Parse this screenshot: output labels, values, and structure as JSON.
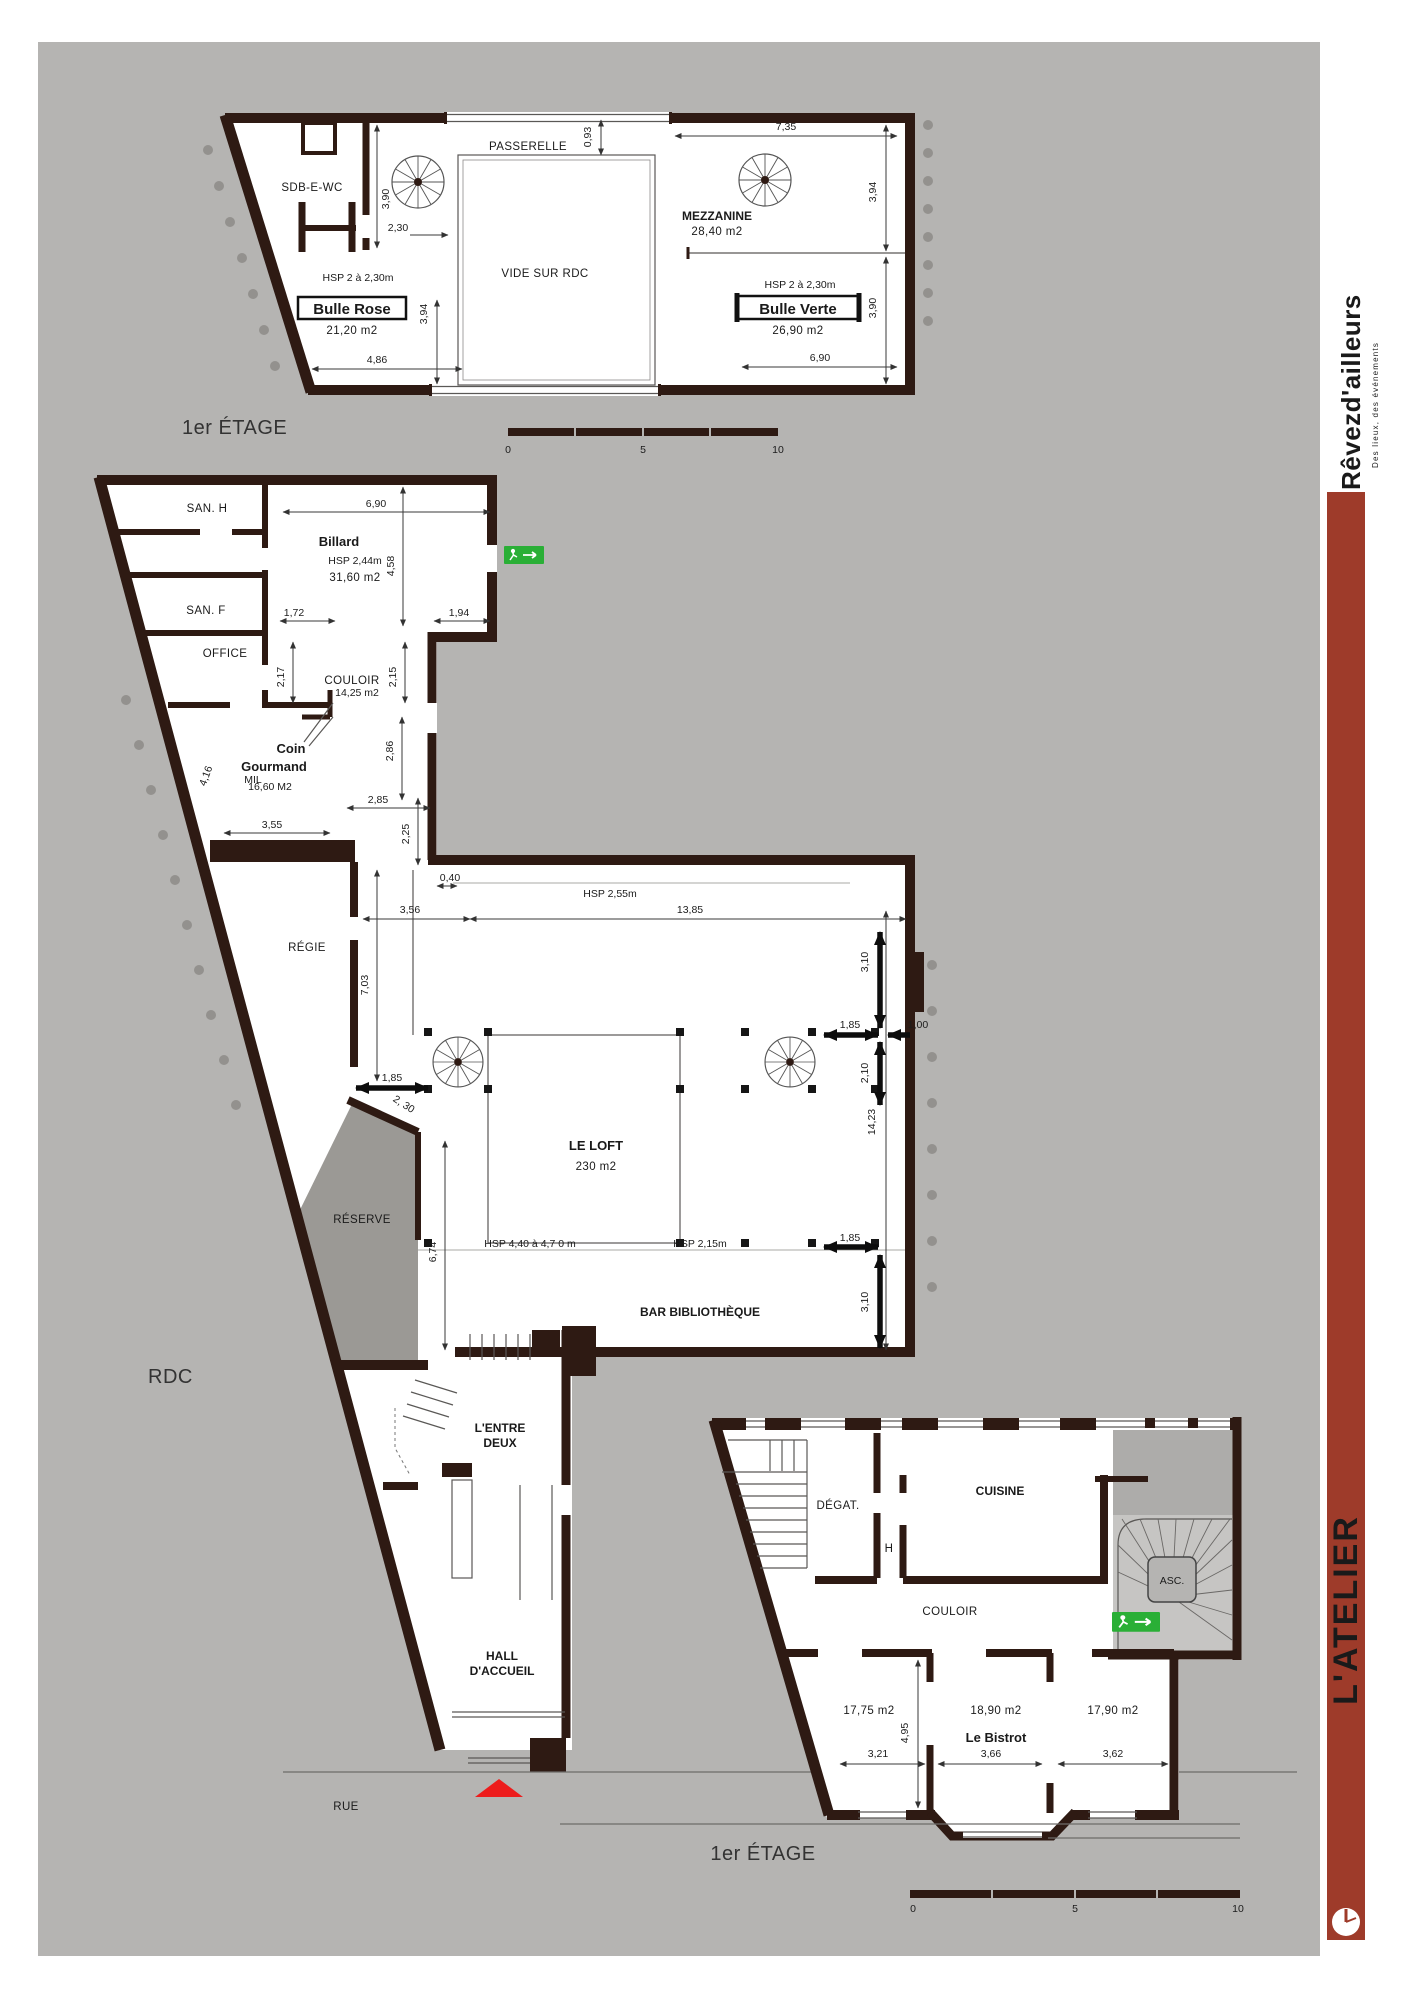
{
  "brand": {
    "logo": "Rêvezd'ailleurs",
    "tagline": "Des lieux, des événements",
    "name": "L'ATELIER"
  },
  "titles": {
    "top": "1er ÉTAGE",
    "rdc": "RDC",
    "bistrot": "1er ÉTAGE"
  },
  "street_label": "RUE",
  "scale": {
    "zero": "0",
    "five": "5",
    "ten": "10"
  },
  "colors": {
    "wall": "#2e1a13",
    "canvas": "#b5b4b2",
    "reserve_gray": "#9b9995",
    "accent_red": "#9e3b2a",
    "exit_green": "#2aaf36",
    "marker_red": "#ed1c1c"
  },
  "top_plan": {
    "labels": {
      "sdb": "SDB-E-WC",
      "passerelle": "PASSERELLE",
      "vide": "VIDE SUR RDC",
      "mezzanine": "MEZZANINE",
      "mezzanine_area": "28,40 m2",
      "hsp_left": "HSP 2 à 2,30m",
      "hsp_right": "HSP 2 à 2,30m",
      "bulle_rose": "Bulle Rose",
      "bulle_rose_area": "21,20 m2",
      "bulle_verte": "Bulle Verte",
      "bulle_verte_area": "26,90 m2"
    },
    "dims": {
      "d093": "0,93",
      "d735": "7,35",
      "d390_left": "3,90",
      "d230": "2,30",
      "d394_left": "3,94",
      "d486": "4,86",
      "d394_right": "3,94",
      "d390_right": "3,90",
      "d690": "6,90"
    }
  },
  "rdc_plan": {
    "labels": {
      "san_h": "SAN. H",
      "san_f": "SAN. F",
      "office": "OFFICE",
      "billard": "Billard",
      "billard_hsp": "HSP 2,44m",
      "billard_area": "31,60 m2",
      "couloir": "COULOIR",
      "couloir_area": "14,25 m2",
      "coin_line1": "Coin",
      "coin_line2": "Gourmand",
      "mil": "MIL",
      "mil_area": "16,60 M2",
      "regie": "RÉGIE",
      "reserve": "RÉSERVE",
      "hsp_loft": "HSP 2,55m",
      "loft": "LE LOFT",
      "loft_area": "230 m2",
      "hsp_high": "HSP 4,40 à 4,7 0 m",
      "hsp_215": "HSP 2,15m",
      "bar": "BAR BIBLIOTHÈQUE",
      "entre_line1": "L'ENTRE",
      "entre_line2": "DEUX",
      "hall_line1": "HALL",
      "hall_line2": "D'ACCUEIL"
    },
    "dims": {
      "d690": "6,90",
      "d458": "4,58",
      "d172": "1,72",
      "d194": "1,94",
      "d217": "2,17",
      "d215": "2,15",
      "d286": "2,86",
      "d285": "2,85",
      "d355": "3,55",
      "d225": "2,25",
      "d416": "4,16",
      "d040": "0,40",
      "d356": "3,56",
      "d1385": "13,85",
      "d310_top": "3,10",
      "d703": "7,03",
      "d185_left": "1,85",
      "d185_right": "1,85",
      "d100": "1,00",
      "d210": "2,10",
      "d230_diag": "2, 30",
      "d1423": "14,23",
      "d674": "6,74",
      "d185_bottom": "1,85",
      "d310_bottom": "3,10"
    }
  },
  "bistrot_plan": {
    "labels": {
      "degat": "DÉGAT.",
      "h": "H",
      "cuisine": "CUISINE",
      "couloir": "COULOIR",
      "asc": "ASC.",
      "area1": "17,75 m2",
      "area2": "18,90 m2",
      "area3": "17,90 m2",
      "bistrot": "Le Bistrot"
    },
    "dims": {
      "d495": "4,95",
      "d321": "3,21",
      "d366": "3,66",
      "d362": "3,62"
    }
  }
}
